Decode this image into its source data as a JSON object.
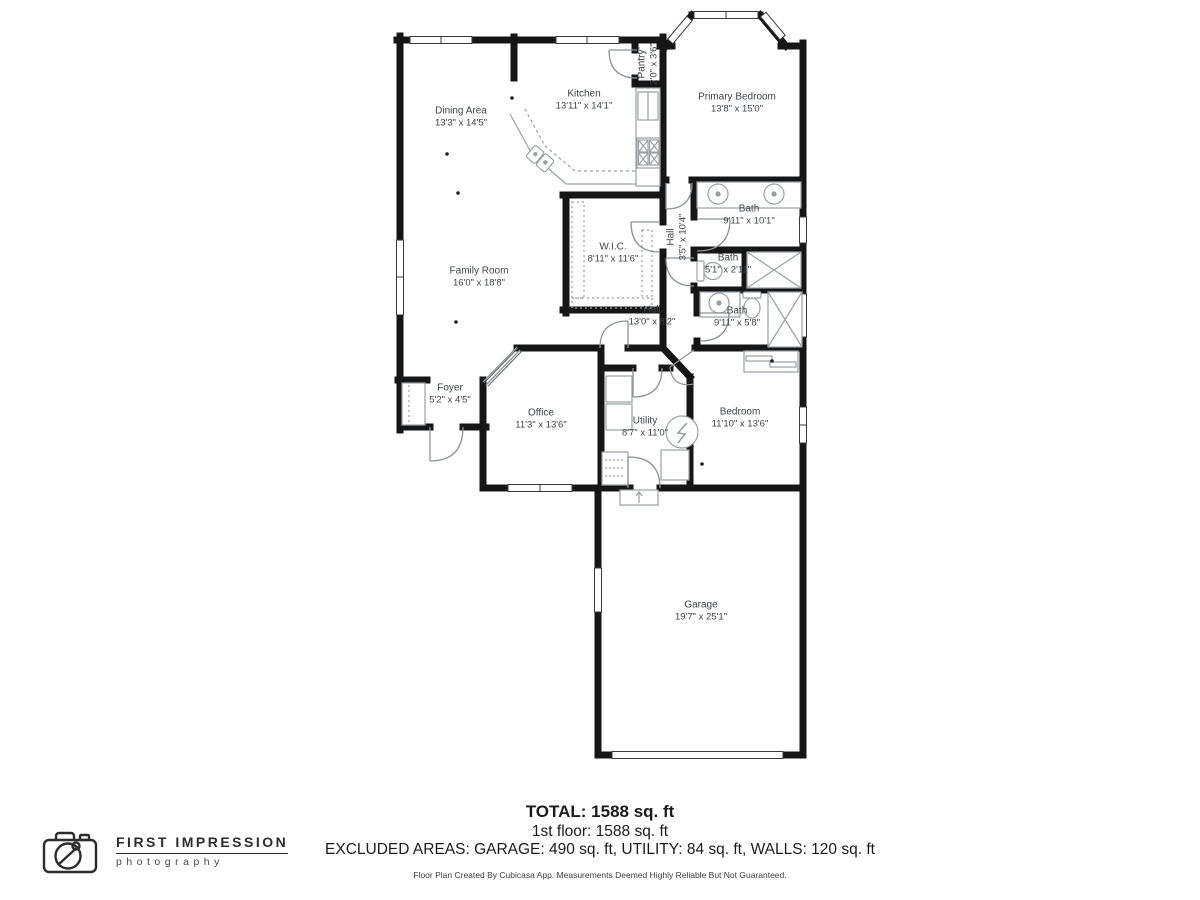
{
  "rooms": [
    {
      "name": "Dining Area",
      "dims": "13'3\" x 14'5\"",
      "x": 461,
      "y": 117,
      "rotate": false
    },
    {
      "name": "Kitchen",
      "dims": "13'11\" x 14'1\"",
      "x": 584,
      "y": 100,
      "rotate": false
    },
    {
      "name": "Pantry",
      "dims": "2'0\" x 3'6\"",
      "x": 648,
      "y": 64,
      "rotate": true
    },
    {
      "name": "Primary Bedroom",
      "dims": "13'8\" x 15'0\"",
      "x": 737,
      "y": 103,
      "rotate": false
    },
    {
      "name": "Bath",
      "dims": "9'11\" x 10'1\"",
      "x": 749,
      "y": 215,
      "rotate": false
    },
    {
      "name": "Hall",
      "dims": "3'5\" x 10'4\"",
      "x": 677,
      "y": 237,
      "rotate": true
    },
    {
      "name": "W.I.C.",
      "dims": "8'11\" x 11'6\"",
      "x": 613,
      "y": 253,
      "rotate": false
    },
    {
      "name": "Bath",
      "dims": "5'1\" x 2'11\"",
      "x": 728,
      "y": 264,
      "rotate": false
    },
    {
      "name": "Bath",
      "dims": "9'11\" x 5'8\"",
      "x": 737,
      "y": 317,
      "rotate": false
    },
    {
      "name": "Hall",
      "dims": "13'0\" x 8'2\"",
      "x": 652,
      "y": 316,
      "rotate": false
    },
    {
      "name": "Family Room",
      "dims": "16'0\" x 18'8\"",
      "x": 479,
      "y": 277,
      "rotate": false
    },
    {
      "name": "Foyer",
      "dims": "5'2\" x 4'5\"",
      "x": 450,
      "y": 394,
      "rotate": false
    },
    {
      "name": "Office",
      "dims": "11'3\" x 13'6\"",
      "x": 541,
      "y": 419,
      "rotate": false
    },
    {
      "name": "Utility",
      "dims": "8'7\" x 11'0\"",
      "x": 645,
      "y": 427,
      "rotate": false
    },
    {
      "name": "Bedroom",
      "dims": "11'10\" x 13'6\"",
      "x": 740,
      "y": 418,
      "rotate": false
    },
    {
      "name": "Garage",
      "dims": "19'7\" x 25'1\"",
      "x": 701,
      "y": 611,
      "rotate": false
    }
  ],
  "summary": {
    "total": "TOTAL: 1588 sq. ft",
    "floor": "1st floor: 1588 sq. ft",
    "excluded": "EXCLUDED AREAS: GARAGE: 490 sq. ft, UTILITY: 84 sq. ft, WALLS: 120 sq. ft",
    "disclaimer": "Floor Plan Created By Cubicasa App. Measurements Deemed Highly Reliable But Not Guaranteed."
  },
  "logo": {
    "line1": "FIRST IMPRESSION",
    "line2": "photography",
    "icon": "camera-icon"
  },
  "colors": {
    "wall": "#161616",
    "label_text": "#3f4347",
    "fixture": "#9aa0a4",
    "door": "#8d9296",
    "summary_text": "#1b1b1b"
  }
}
